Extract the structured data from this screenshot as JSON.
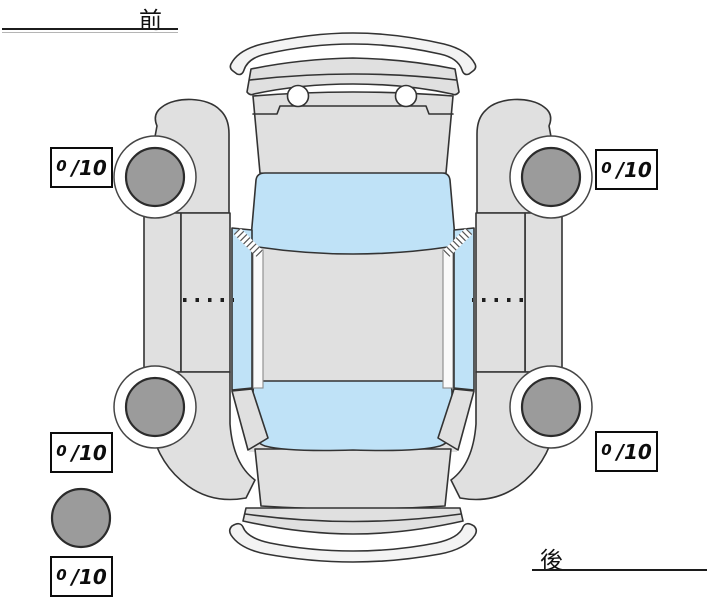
{
  "diagram": {
    "front_label": "前",
    "rear_label": "後",
    "tread_scores": {
      "front_left": {
        "value": "0",
        "suffix": "/10"
      },
      "front_right": {
        "value": "0",
        "suffix": "/10"
      },
      "rear_left": {
        "value": "0",
        "suffix": "/10"
      },
      "rear_right": {
        "value": "0",
        "suffix": "/10"
      },
      "spare": {
        "value": "0",
        "suffix": "/10"
      }
    }
  },
  "colors": {
    "background": "#ffffff",
    "body": "#e0e0e0",
    "glass": "#bfe2f7",
    "tire": "#9b9b9b",
    "outline": "#333333"
  }
}
